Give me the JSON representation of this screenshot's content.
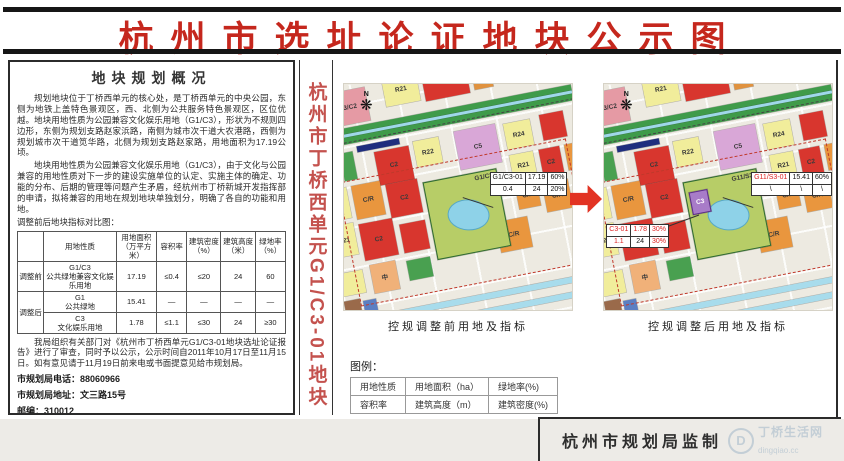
{
  "title": "杭州市选址论证地块公示图",
  "strip_title": "杭州市丁桥西单元G1/C3-01地块",
  "overview": {
    "heading": "地块规划概况",
    "para1": "规划地块位于丁桥西单元的核心处，是丁桥西单元的中央公园，东侧为地铁上盖特色景观区，西、北侧为公共服务特色景观区，区位优越。地块用地性质为公园兼容文化娱乐用地（G1/C3），形状为不规则四边形，东侧为规划支路赵家浜路，南侧为城市次干道大农港路，西侧为规划城市次干道笕华路，北侧为规划支路赵家路，用地面积为17.19公顷。",
    "para2": "地块用地性质为公园兼容文化娱乐用地（G1/C3），由于文化与公园兼容的用地性质对下一步的建设实施单位的认定、实施主体的确定、功能的分布、后期的管理等问题产生矛盾，经杭州市丁桥新城开发指挥部的申请，拟将兼容的用地在规划地块单独划分，明确了各自的功能和用地。",
    "para2b": "调整前后地块指标对比图：",
    "table": {
      "headers": [
        "",
        "用地性质",
        "用地面积\n（万平方米）",
        "容积率",
        "建筑密度\n（%）",
        "建筑高度\n（米）",
        "绿地率\n（%）"
      ],
      "rows": [
        [
          "调整前",
          "G1/C3\n公共绿地兼容文化娱乐用地",
          "17.19",
          "≤0.4",
          "≤20",
          "24",
          "60"
        ],
        [
          "调整后",
          "G1\n公共绿地",
          "15.41",
          "—",
          "—",
          "—",
          "—"
        ],
        [
          "",
          "C3\n文化娱乐用地",
          "1.78",
          "≤1.1",
          "≤30",
          "24",
          "≥30"
        ]
      ]
    },
    "notice": "我局组织有关部门对《杭州市丁桥西单元G1/C3-01地块选址论证报告》进行了审查，同时予以公示，公示时间自2011年10月17日至11月15日。如有意见请于11月19日前来电或书面提意见给市规划局。",
    "phone": "市规划局电话：88060966",
    "address": "市规划局地址：文三路15号",
    "postcode": "邮编：310012",
    "note": "（注：如果对公示内容有不明的，请向规划局咨询）",
    "issuer": "杭州市规划局",
    "date": "2011年10月15日"
  },
  "maps": {
    "compass_n": "N",
    "compass_star": "❋",
    "before": {
      "caption": "控规调整前用地及指标",
      "park_label": "G1/C3",
      "callouts": [
        {
          "pos": {
            "right": "2%",
            "top": "39%"
          },
          "rows": [
            [
              "G1/C3-01",
              "17.19",
              "60%"
            ],
            [
              "0.4",
              "24",
              "20%"
            ]
          ],
          "red": [
            [
              false,
              false,
              false
            ],
            [
              false,
              false,
              false
            ]
          ]
        }
      ]
    },
    "after": {
      "caption": "控规调整后用地及指标",
      "park_label": "G11/S3",
      "new_parcel_label": "C3",
      "callouts": [
        {
          "pos": {
            "right": "0%",
            "top": "39%"
          },
          "rows": [
            [
              "G11/S3-01",
              "15.41",
              "60%"
            ],
            [
              "\\",
              "\\",
              "\\"
            ]
          ],
          "red": [
            [
              true,
              false,
              false
            ],
            [
              false,
              false,
              false
            ]
          ]
        },
        {
          "pos": {
            "left": "1%",
            "top": "62%"
          },
          "rows": [
            [
              "C3-01",
              "1.78",
              "30%"
            ],
            [
              "1.1",
              "24",
              "30%"
            ]
          ],
          "red": [
            [
              true,
              true,
              true
            ],
            [
              true,
              false,
              true
            ]
          ]
        }
      ]
    }
  },
  "map_parcels": {
    "shared": [
      {
        "x": 8,
        "y": 2,
        "w": 15,
        "h": 13,
        "c": "#e59aa4",
        "l": "C3/C2"
      },
      {
        "x": 30,
        "y": 0,
        "w": 13,
        "h": 11,
        "c": "#f1ed9b",
        "l": "R21"
      },
      {
        "x": 45,
        "y": 0,
        "w": 17,
        "h": 12,
        "c": "#d8362e",
        "l": "C2"
      },
      {
        "x": 64,
        "y": 1,
        "w": 7,
        "h": 10,
        "c": "#e0923f",
        "l": ""
      },
      {
        "x": 73,
        "y": 0,
        "w": 8,
        "h": 9,
        "c": "#5b7fc3",
        "l": ""
      },
      {
        "x": 83,
        "y": 0,
        "w": 9,
        "h": 9,
        "c": "#49a050",
        "l": ""
      },
      {
        "x": 94,
        "y": 0,
        "w": 6,
        "h": 9,
        "c": "#d8362e",
        "l": ""
      },
      {
        "x": 0,
        "y": 16,
        "w": 100,
        "h": 6,
        "c": "#3f9b4a",
        "l": ""
      },
      {
        "x": 0,
        "y": 18.2,
        "w": 100,
        "h": 1.2,
        "c": "#9fd8ea",
        "l": ""
      },
      {
        "x": 16,
        "y": 23.5,
        "w": 16,
        "h": 2.6,
        "c": "#1f2e7e",
        "l": ""
      },
      {
        "x": 0,
        "y": 25,
        "w": 7,
        "h": 11,
        "c": "#e0923f",
        "l": "C4"
      },
      {
        "x": 9,
        "y": 25,
        "w": 5,
        "h": 11,
        "c": "#49a050",
        "l": ""
      },
      {
        "x": 22,
        "y": 27,
        "w": 13,
        "h": 13,
        "c": "#d8362e",
        "l": "C2"
      },
      {
        "x": 37,
        "y": 26,
        "w": 10,
        "h": 10,
        "c": "#f1ed9b",
        "l": "R22"
      },
      {
        "x": 53,
        "y": 25,
        "w": 16,
        "h": 15,
        "c": "#d9a7d7",
        "l": "C5"
      },
      {
        "x": 72,
        "y": 26,
        "w": 10,
        "h": 10,
        "c": "#f1ed9b",
        "l": "R24"
      },
      {
        "x": 86,
        "y": 25,
        "w": 9,
        "h": 10,
        "c": "#d8362e",
        "l": ""
      },
      {
        "x": 0,
        "y": 38,
        "w": 9,
        "h": 12,
        "c": "#f1ed9b",
        "l": "R21"
      },
      {
        "x": 11,
        "y": 38,
        "w": 11,
        "h": 13,
        "c": "#e9963e",
        "l": "C/R"
      },
      {
        "x": 24,
        "y": 40,
        "w": 12,
        "h": 13,
        "c": "#d8362e",
        "l": "C2"
      },
      {
        "x": 72,
        "y": 38,
        "w": 9,
        "h": 10,
        "c": "#f1ed9b",
        "l": "R21"
      },
      {
        "x": 83,
        "y": 38,
        "w": 8,
        "h": 11,
        "c": "#d8362e",
        "l": "C2"
      },
      {
        "x": 93,
        "y": 38,
        "w": 7,
        "h": 10,
        "c": "#e9963e",
        "l": ""
      },
      {
        "x": 0,
        "y": 52,
        "w": 9,
        "h": 12,
        "c": "#f1ed9b",
        "l": "R21"
      },
      {
        "x": 11,
        "y": 53,
        "w": 13,
        "h": 14,
        "c": "#d8362e",
        "l": "C2"
      },
      {
        "x": 26,
        "y": 56,
        "w": 10,
        "h": 11,
        "c": "#d8362e",
        "l": ""
      },
      {
        "x": 72,
        "y": 50,
        "w": 8,
        "h": 9,
        "c": "#e9963e",
        "l": "C/R"
      },
      {
        "x": 82,
        "y": 51,
        "w": 10,
        "h": 11,
        "c": "#e9963e",
        "l": "C/R"
      },
      {
        "x": 94,
        "y": 50,
        "w": 6,
        "h": 9,
        "c": "#f1ed9b",
        "l": ""
      },
      {
        "x": 62,
        "y": 62,
        "w": 12,
        "h": 12,
        "c": "#e9963e",
        "l": "C/R"
      },
      {
        "x": 12,
        "y": 69,
        "w": 10,
        "h": 11,
        "c": "#f0b179",
        "l": "中"
      },
      {
        "x": 0,
        "y": 70,
        "w": 9,
        "h": 9,
        "c": "#f1ed9b",
        "l": ""
      },
      {
        "x": 26,
        "y": 70,
        "w": 9,
        "h": 8,
        "c": "#49a050",
        "l": ""
      },
      {
        "x": 0,
        "y": 81,
        "w": 6,
        "h": 14,
        "c": "#9a6a4a",
        "l": ""
      },
      {
        "x": 7,
        "y": 82,
        "w": 5,
        "h": 10,
        "c": "#5b7fc3",
        "l": ""
      },
      {
        "x": 0,
        "y": 88,
        "w": 100,
        "h": 2.4,
        "c": "#a8dcec",
        "l": ""
      },
      {
        "x": 0,
        "y": 94,
        "w": 100,
        "h": 2,
        "c": "#a8dcec",
        "l": ""
      }
    ],
    "park": {
      "x": 38,
      "y": 42,
      "w": 28,
      "h": 30,
      "c": "#b7cd67"
    },
    "lake": {
      "x": 45,
      "y": 52,
      "w": 15,
      "h": 11,
      "c": "#8ed2e8"
    },
    "new_parcel": {
      "x": 39.5,
      "y": 46,
      "w": 7,
      "h": 9,
      "c": "#a87cc8"
    }
  },
  "legend": {
    "title": "图例：",
    "rows": [
      [
        "用地性质",
        "用地面积（ha）",
        "绿地率(%)"
      ],
      [
        "容积率",
        "建筑高度（m）",
        "建筑密度(%)"
      ]
    ]
  },
  "footer": {
    "producer": "杭州市规划局监制",
    "watermark_initial": "D",
    "watermark_name": "丁桥生活网",
    "watermark_domain": "dingqiao.cc"
  },
  "colors": {
    "title_red": "#c5271d",
    "strip_red": "#c4524e",
    "arrow_red": "#e23323"
  }
}
